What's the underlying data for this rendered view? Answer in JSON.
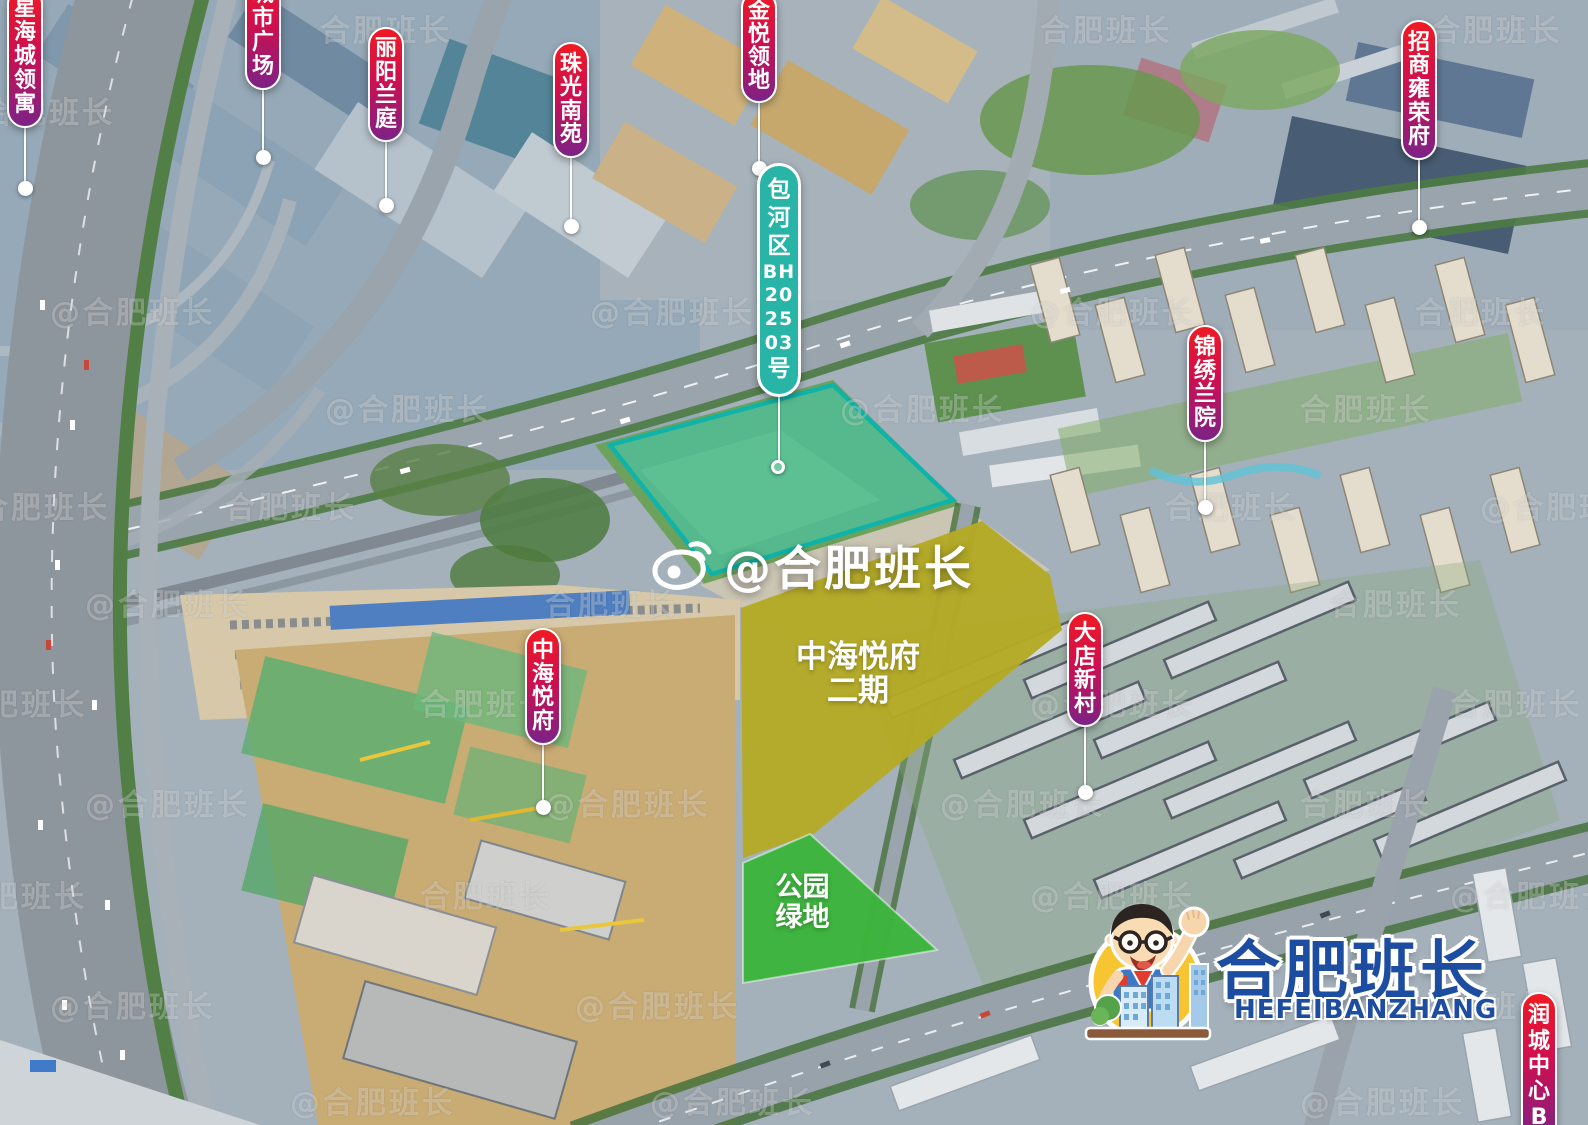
{
  "watermarks": {
    "center_text": "@合肥班长",
    "tile_full": "@合肥班长",
    "tile_short": "合肥班长"
  },
  "parcels": {
    "site": {
      "full_label": "包河区BH202503号",
      "label_chars": [
        "包",
        "河",
        "区",
        "BH",
        "20",
        "25",
        "03",
        "号"
      ]
    },
    "phase2": {
      "line1": "中海悦府",
      "line2": "二期"
    },
    "park": {
      "line1": "公园",
      "line2": "绿地"
    }
  },
  "pins": [
    {
      "id": "xinghaicheng-lingyu",
      "text": "星海城领寓",
      "x": 7,
      "y": -14,
      "w": 36,
      "h": 142,
      "dot": [
        25,
        188
      ]
    },
    {
      "id": "chengshi-guangchang",
      "text": "城市广场",
      "x": 245,
      "y": -28,
      "w": 36,
      "h": 118,
      "dot": [
        263,
        157
      ]
    },
    {
      "id": "liyang-lanting",
      "text": "丽阳兰庭",
      "x": 368,
      "y": 27,
      "w": 36,
      "h": 115,
      "dot": [
        386,
        205
      ]
    },
    {
      "id": "zhuguang-nanyuan",
      "text": "珠光南苑",
      "x": 553,
      "y": 42,
      "w": 36,
      "h": 116,
      "dot": [
        571,
        226
      ]
    },
    {
      "id": "jinyue-lingdi",
      "text": "金悦领地",
      "x": 741,
      "y": -10,
      "w": 36,
      "h": 113,
      "dot": [
        759,
        168
      ]
    },
    {
      "id": "zhaoshang-yongrongfu",
      "text": "招商雍荣府",
      "x": 1401,
      "y": 20,
      "w": 36,
      "h": 140,
      "dot": [
        1419,
        227
      ]
    },
    {
      "id": "jinxiu-lanyuan",
      "text": "锦绣兰院",
      "x": 1187,
      "y": 325,
      "w": 36,
      "h": 117,
      "dot": [
        1205,
        507
      ]
    },
    {
      "id": "dadian-xincun",
      "text": "大店新村",
      "x": 1067,
      "y": 612,
      "w": 36,
      "h": 115,
      "dot": [
        1085,
        792
      ]
    },
    {
      "id": "zhonghai-yuefu",
      "text": "中海悦府",
      "x": 525,
      "y": 628,
      "w": 36,
      "h": 117,
      "dot": [
        543,
        807
      ]
    },
    {
      "id": "runcheng-zhongxin-b",
      "text": "润城中心B",
      "x": 1521,
      "y": 992,
      "w": 36,
      "h": 150
    },
    {
      "id": "site-parcel-label",
      "variant": "teal",
      "text": "包河区BH202503号",
      "chars": [
        "包",
        "河",
        "区",
        "BH",
        "20",
        "25",
        "03",
        "号"
      ],
      "x": 757,
      "y": 163,
      "w": 44,
      "h": 234,
      "dot": [
        778,
        467
      ],
      "dot_style": "open"
    }
  ],
  "logo": {
    "title": "合肥班长",
    "subtitle": "HEFEIBANZHANG"
  },
  "colors": {
    "pin_gradient_top": "#ef1a23",
    "pin_gradient_bottom": "#7c2287",
    "site_pill_teal": "#28b5a8",
    "parcel_cyan_fill": "rgba(61,212,196,0.48)",
    "parcel_cyan_border": "#10b3a7",
    "phase2_fill": "#b4aa24",
    "park_fill": "#3cb43c",
    "logo_blue": "#1d4da0"
  }
}
